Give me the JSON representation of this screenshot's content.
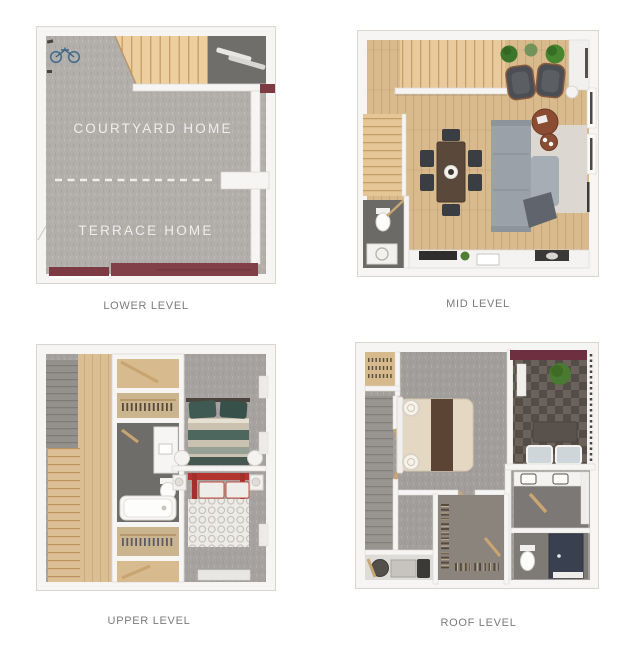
{
  "plans": [
    {
      "id": "lower-level",
      "label": "LOWER LEVEL",
      "room_labels": [
        "COURTYARD HOME",
        "TERRACE HOME"
      ]
    },
    {
      "id": "mid-level",
      "label": "MID LEVEL",
      "room_labels": []
    },
    {
      "id": "upper-level",
      "label": "UPPER LEVEL",
      "room_labels": []
    },
    {
      "id": "roof-level",
      "label": "ROOF LEVEL",
      "room_labels": []
    }
  ],
  "palette": {
    "background": "#ffffff",
    "wall": "#f6f5f3",
    "wall_edge": "#d9d6d2",
    "carpet_gray": "#b2aeaa",
    "carpet_bedroom": "#a6a29f",
    "wood_floor": "#d9ba8d",
    "stair_wood": "#ecce9f",
    "maroon_accent": "#7d3a43",
    "storage_dark": "#6f6e6a",
    "sofa_gray": "#9aa1a9",
    "coffee_table_brown": "#8a4c33",
    "plant_green": "#47862f",
    "bed_red": "#b23530",
    "bed_teal": "#4e6a60",
    "terrace_deck": "#5e5751",
    "shower_navy": "#39404f",
    "caption_text": "#7b7b7b",
    "overlay_text": "#ffffff"
  }
}
